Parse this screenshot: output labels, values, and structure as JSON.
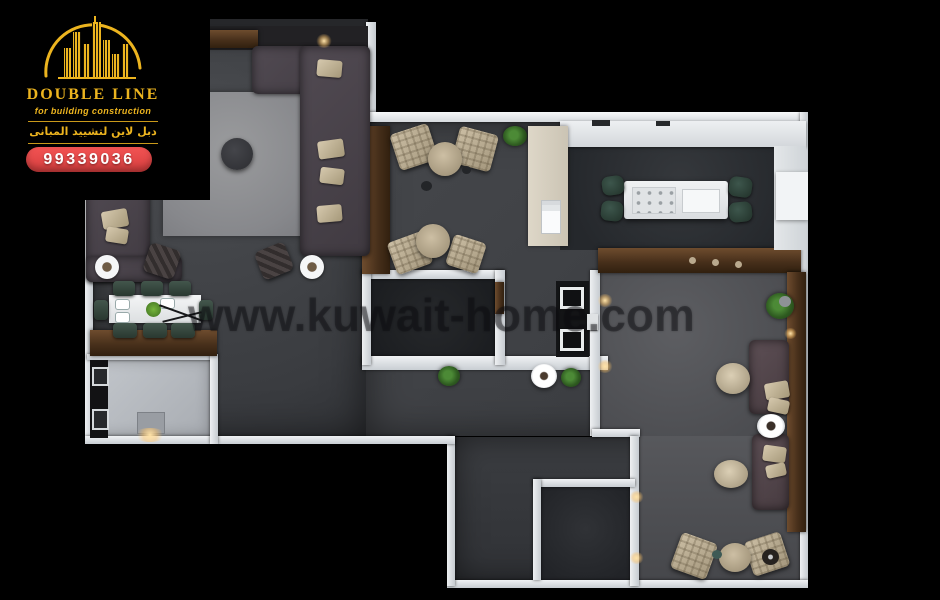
{
  "brand": {
    "name": "DOUBLE LINE",
    "tagline": "for building construction",
    "name_arabic": "دبل لاين لتشييد المبانى",
    "phone": "99339036"
  },
  "watermark": "www.kuwait-home.com",
  "colors": {
    "background": "#000000",
    "brand_gold": "#ecb41f",
    "badge_red": "#e94b4b",
    "wall_white": "#dde1e5",
    "floor_dark": "#3f4246",
    "floor_light_room": "#55575b",
    "foyer_floor": "#b7bbc1",
    "wood_brown": "#5e4029",
    "sofa_gray": "#4a444b",
    "accent_beige": "#c3b69d",
    "dining_chair_green": "#36473f",
    "rug_gray": "#8e8f91"
  }
}
